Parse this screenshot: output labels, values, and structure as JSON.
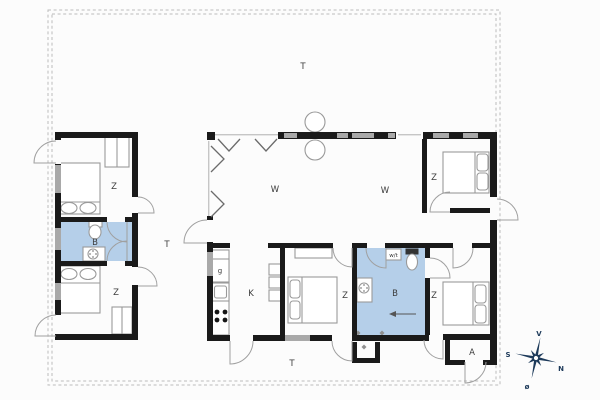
{
  "labels": {
    "terrace_top": "T",
    "terrace_left": "T",
    "terrace_bottom": "T",
    "living_left": "W",
    "living_right": "W",
    "kitchen": "K",
    "bedroom_top_left": "Z",
    "bedroom_bottom_left": "Z",
    "bedroom_middle": "Z",
    "bedroom_top_right": "Z",
    "bedroom_bottom_right": "Z",
    "bathroom_left": "B",
    "bathroom_right": "B",
    "appliance_g": "g",
    "washer_dryer": "w/t",
    "annex": "A"
  },
  "compass": {
    "west": "V",
    "south": "S",
    "north": "N",
    "east": "ø"
  },
  "colors": {
    "wall": "#1a1a1a",
    "window": "#a9a9a9",
    "bathroom_fill": "#b5cfe9",
    "furniture_line": "#9a9a9a",
    "dashed_line": "#bcbcbc",
    "label_text": "#3c3c3c",
    "compass": "#1d3a5a"
  }
}
